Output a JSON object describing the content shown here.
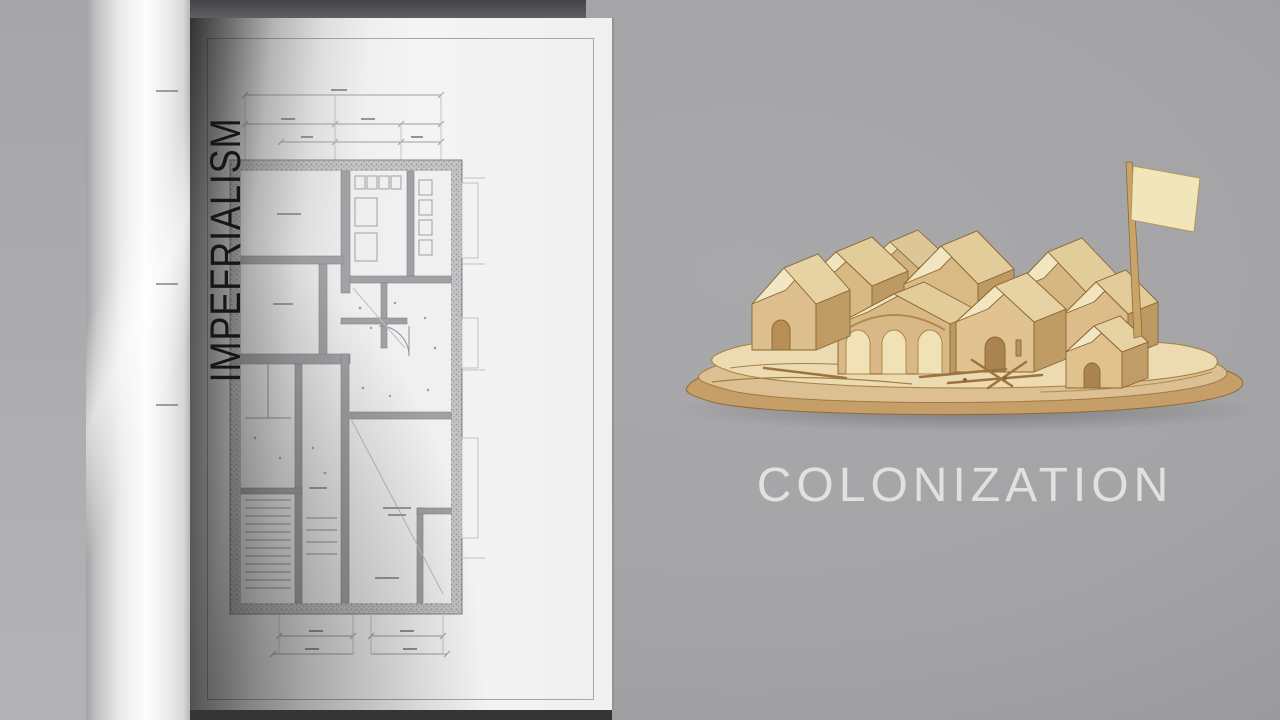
{
  "spine": {
    "title": "IMPEFRIALISM"
  },
  "caption": {
    "title": "COLONIZATION"
  },
  "palette": {
    "background": "#a4a4a6",
    "page": "#f3f3f4",
    "plan_ink": "#8c8c90",
    "wall_fill": "#c2c2c4",
    "spine_text": "#161616",
    "caption_text": "#e1e1e2",
    "wood_roof_light": "#f2e7c3",
    "wood_roof_shade": "#e4d1a0",
    "wood_front": "#dcbe8d",
    "wood_side": "#bf9c64",
    "wood_base_top": "#ecdab0",
    "wood_base_mid": "#dcbf92",
    "wood_base_bottom": "#c69f68",
    "wood_edge": "#8f6a38",
    "flag": "#f1e5ba"
  }
}
